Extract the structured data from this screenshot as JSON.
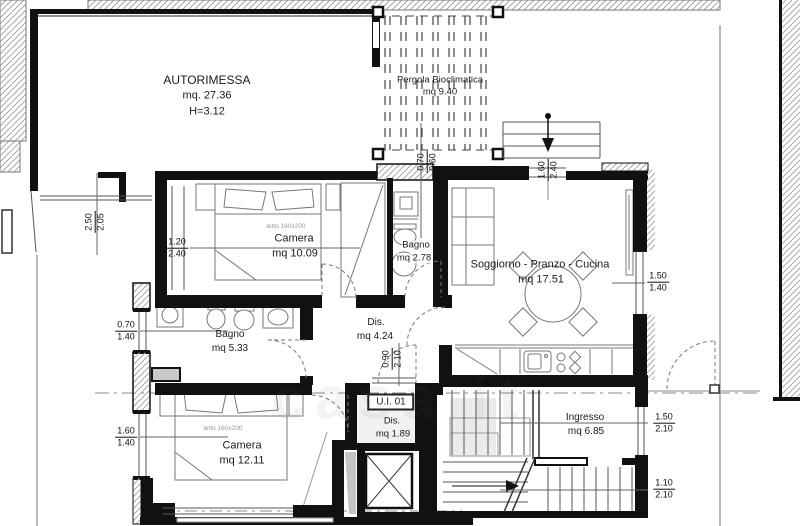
{
  "watermark": "casa it",
  "rooms": {
    "autorimessa": {
      "name": "AUTORIMESSA",
      "area": "mq. 27.36",
      "height": "H=3.12"
    },
    "pergola": {
      "name": "Pergola Bioclimatica",
      "area": "mq 9.40"
    },
    "camera1": {
      "name": "Camera",
      "area": "mq 10.09",
      "bed_note": "letto 160x200"
    },
    "bagno1": {
      "name": "Bagno",
      "area": "mq 2.78"
    },
    "soggiorno": {
      "name": "Soggiorno - Pranzo - Cucina",
      "area": "mq 17.51"
    },
    "bagno2": {
      "name": "Bagno",
      "area": "mq 5.33"
    },
    "disimpegno": {
      "name": "Dis.",
      "area": "mq 4.24"
    },
    "camera2": {
      "name": "Camera",
      "area": "mq 12.11",
      "bed_note": "letto 160x200"
    },
    "unit": {
      "badge": "U.I. 01",
      "name": "Dis.",
      "area": "mq 1.89"
    },
    "ingresso": {
      "name": "Ingresso",
      "area": "mq 6.85"
    }
  },
  "dims": {
    "garage_door": {
      "w": "2.50",
      "h": "2.05"
    },
    "camera1_win": {
      "w": "1.20",
      "h": "2.40"
    },
    "bagno1_win": {
      "w": "0.70",
      "h": "0.60"
    },
    "entry_door": {
      "w": "1.60",
      "h": "2.40"
    },
    "soggiorno_win": {
      "w": "1.50",
      "h": "1.40"
    },
    "bagno2_win": {
      "w": "0.70",
      "h": "1.40"
    },
    "dis_door": {
      "w": "0.90",
      "h": "2.10"
    },
    "camera2_win": {
      "w": "1.60",
      "h": "1.40"
    },
    "ingresso_win": {
      "w": "1.50",
      "h": "2.10"
    },
    "stair_door": {
      "w": "1.10",
      "h": "2.10"
    }
  }
}
